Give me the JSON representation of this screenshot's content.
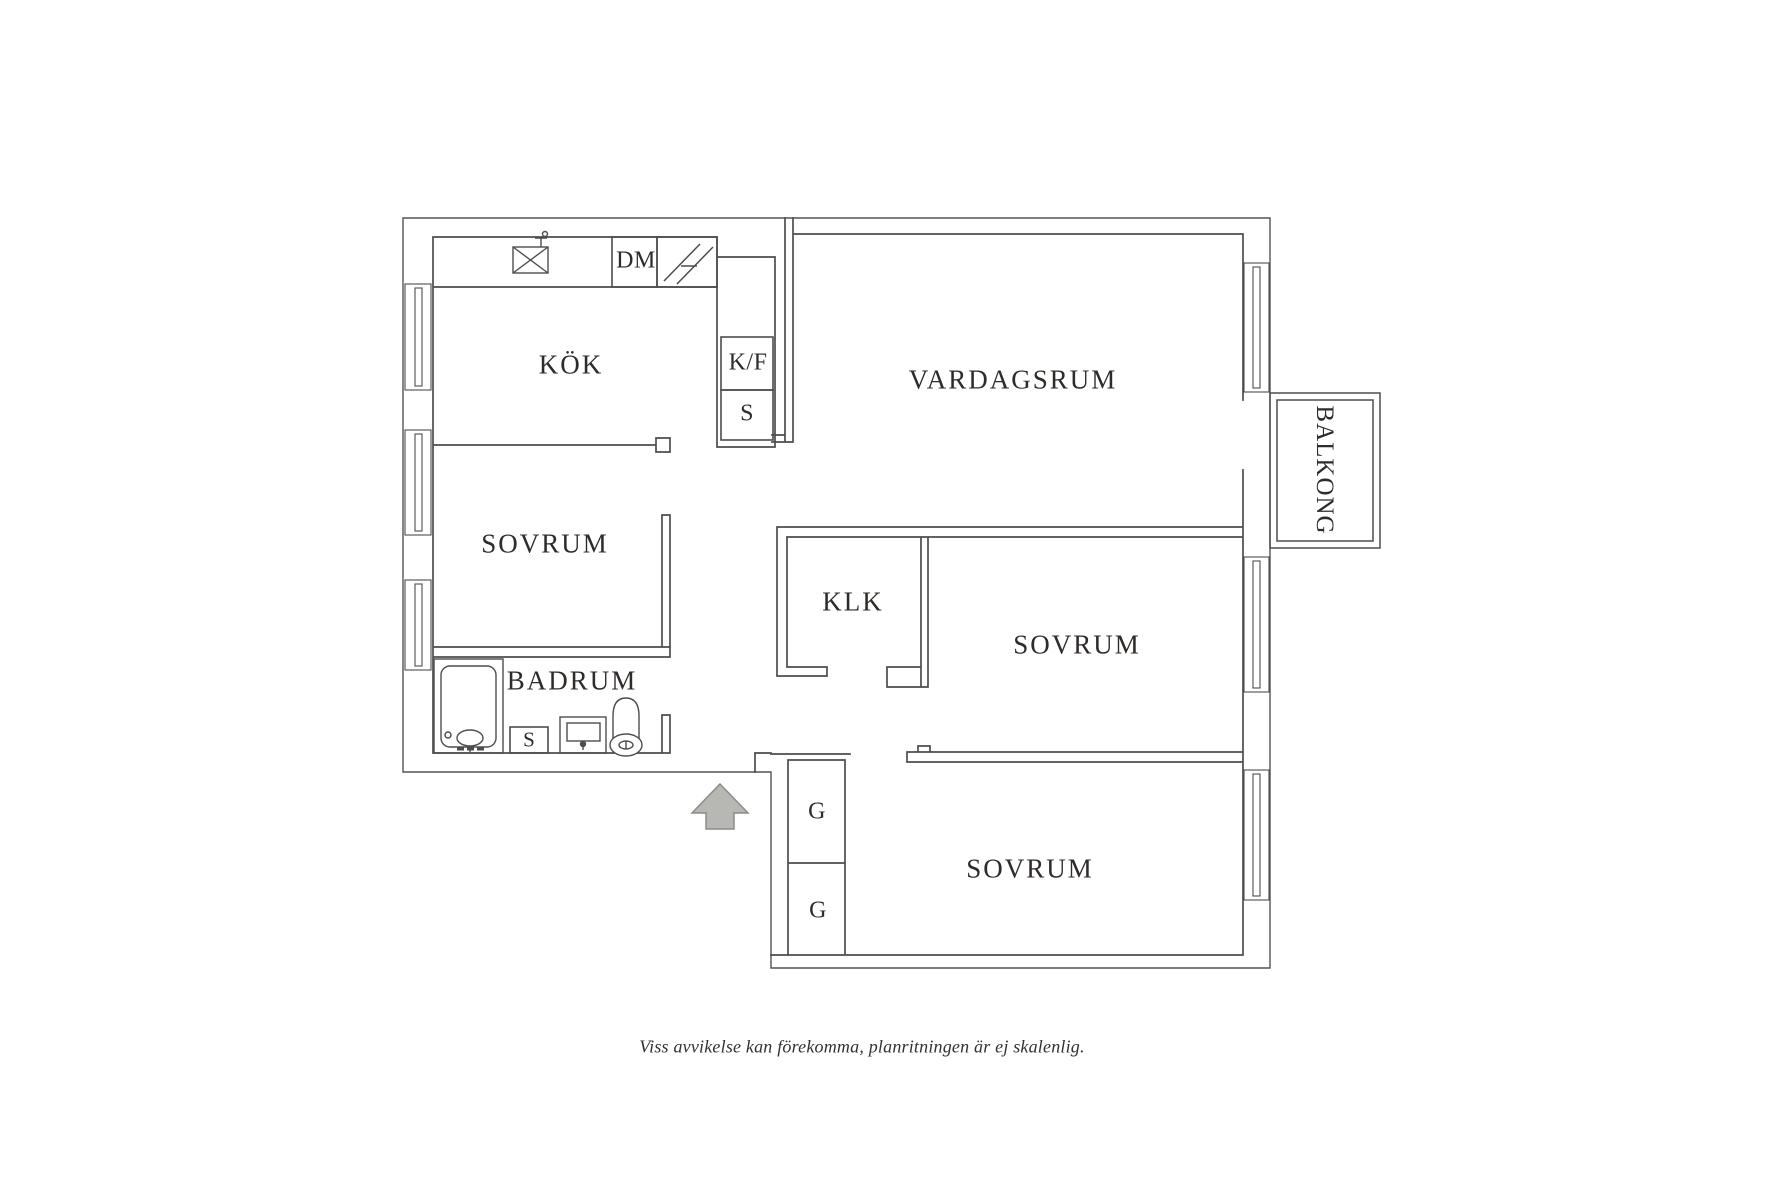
{
  "plan": {
    "title_rooms": {
      "kok": "KÖK",
      "vardagsrum": "VARDAGSRUM",
      "sovrum_left": "SOVRUM",
      "badrum": "BADRUM",
      "klk": "KLK",
      "sovrum_middle": "SOVRUM",
      "sovrum_bottom": "SOVRUM",
      "balkong": "BALKONG"
    },
    "fixtures": {
      "dishwasher": "DM",
      "fridge_freezer": "K/F",
      "cabinet_kitchen": "S",
      "cabinet_badrum": "S",
      "wardrobe_top": "G",
      "wardrobe_bottom": "G"
    },
    "icons": [
      "sink-icon",
      "stove-icon",
      "shower-icon",
      "washbasin-icon",
      "toilet-icon",
      "entrance-arrow-icon",
      "window-icon",
      "balcony"
    ],
    "disclaimer": "Viss avvikelse kan förekomma, planritningen är ej skalenlig.",
    "colors": {
      "line": "#4d4d4d",
      "text": "#2e2b29",
      "arrow_fill": "#b7b7b4",
      "arrow_stroke": "#8c8c89",
      "background": "#ffffff"
    }
  }
}
